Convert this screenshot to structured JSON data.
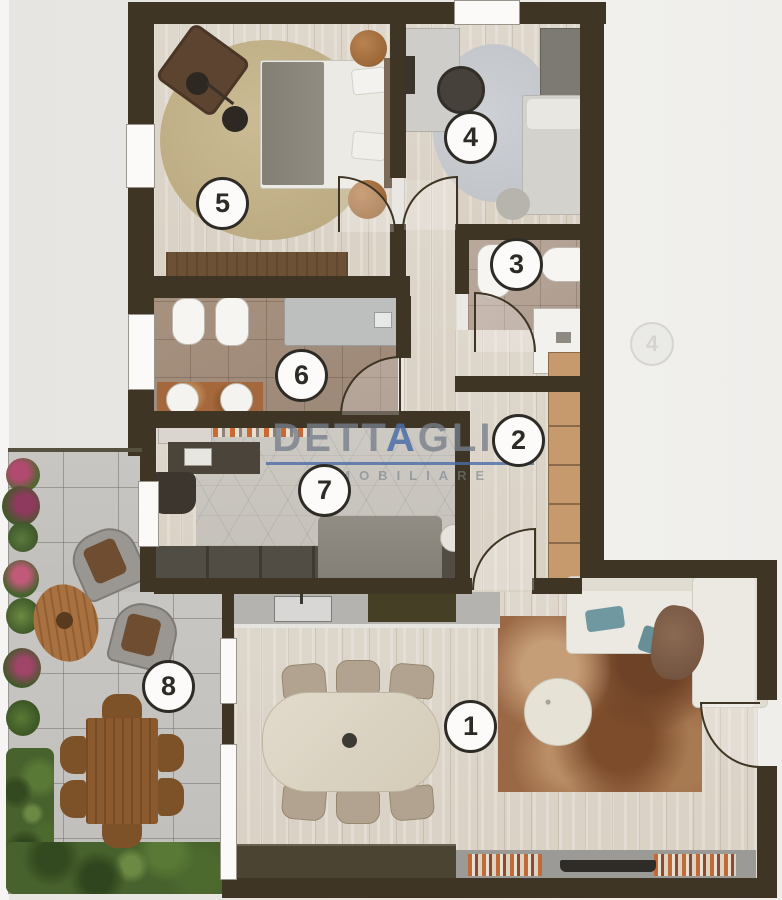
{
  "plan": {
    "type": "apartment-floor-plan",
    "rooms": [
      {
        "number": "1",
        "kind": "living-dining-kitchen"
      },
      {
        "number": "2",
        "kind": "hallway"
      },
      {
        "number": "3",
        "kind": "bathroom-small"
      },
      {
        "number": "4",
        "kind": "study-bedroom"
      },
      {
        "number": "5",
        "kind": "master-bedroom"
      },
      {
        "number": "6",
        "kind": "bathroom-large"
      },
      {
        "number": "7",
        "kind": "bedroom"
      },
      {
        "number": "8",
        "kind": "terrace"
      }
    ],
    "ghost_marker": {
      "label": "4"
    }
  },
  "brand": {
    "word_part1": "DETT",
    "word_letter_a": "A",
    "word_part2": "GLIO",
    "line2": "IMMOBILIARE",
    "text_color": "#767e8a",
    "accent_color": "#4a6da8"
  },
  "colors": {
    "wall": "#3e3524",
    "paper": "#e9e7e3",
    "wood_floor": "#dcd5c9",
    "bath_tile": "#a7917f",
    "terrace_tile": "#c5c3bf",
    "rug_bedroom": "#c2b189",
    "rug_living": "#9a6845",
    "wardrobe_tan": "#c79a6d",
    "badge_border": "#2e2b27"
  }
}
